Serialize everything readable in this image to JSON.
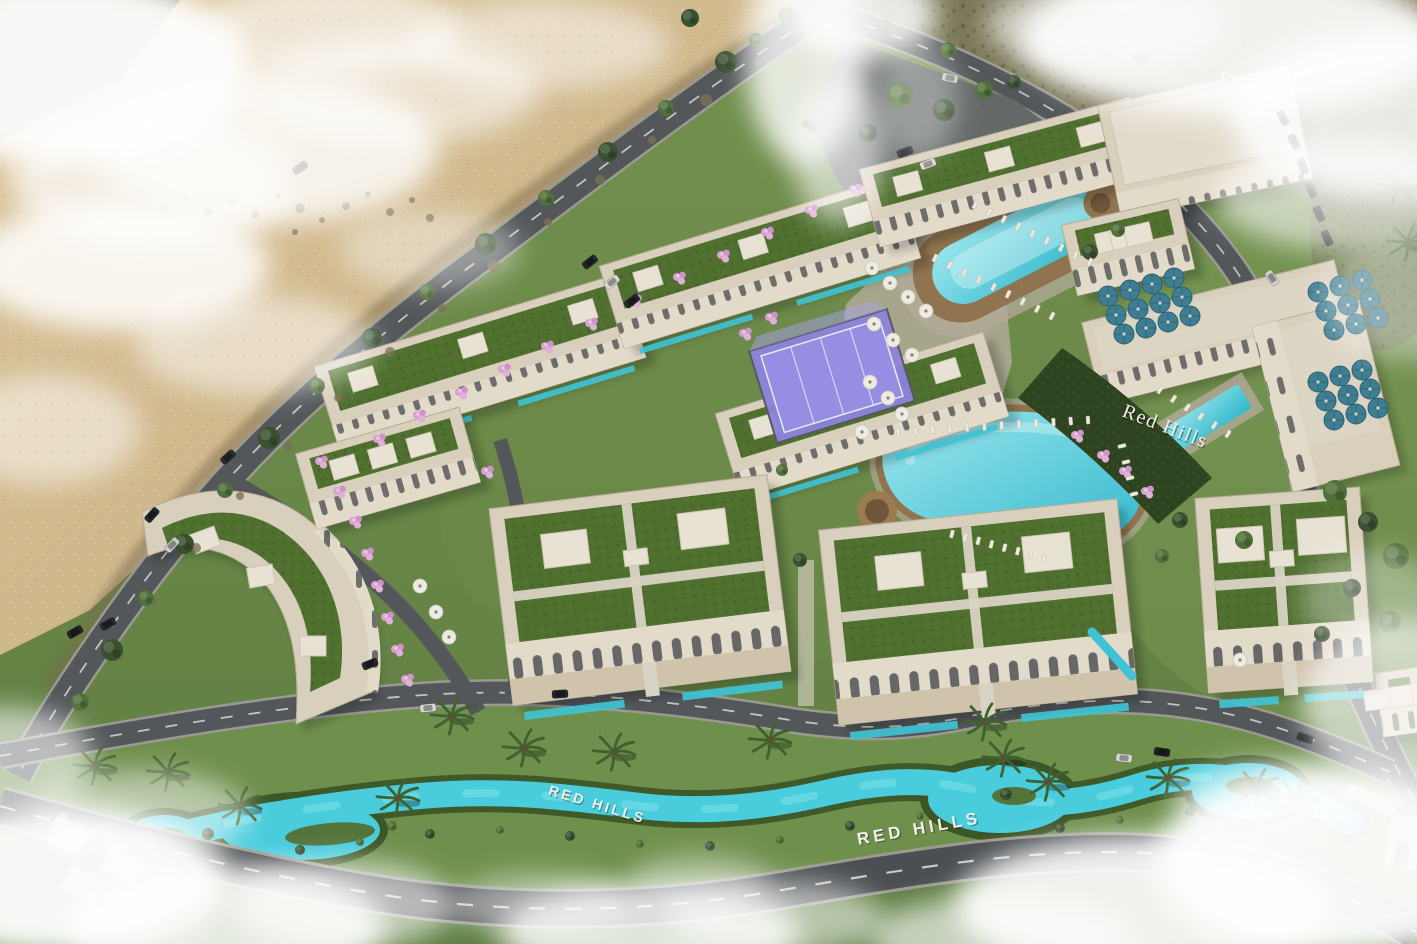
{
  "signs": {
    "hillside": "Red Hills",
    "lawn_west": "RED HILLS",
    "lawn_center": "RED HILLS"
  },
  "palette": {
    "sand": "#d2ba8e",
    "sand_dark": "#b89d72",
    "scrub": "#7b7757",
    "grass": "#6b8a4a",
    "grass_light": "#6f8f4c",
    "hedge_dark": "#2e4420",
    "road_asphalt": "#53575a",
    "road_outer": "#4b4f52",
    "sidewalk": "#9a9a92",
    "building_beige": "#d9cfbd",
    "building_facade": "#e3dbc9",
    "roof_green": "#50702f",
    "roof_white": "#e2dccd",
    "pool_water": "#3fc3d4",
    "canal_water": "#49ccdc",
    "wood_deck": "#8f744f",
    "padel_purple": "#8d84dc",
    "umbrella_teal": "#3e7e92",
    "umbrella_white": "#ecebe4",
    "flower_pink": "#d9a0d2",
    "cloud_white": "#ffffff",
    "sign_white": "#f0ede2"
  }
}
